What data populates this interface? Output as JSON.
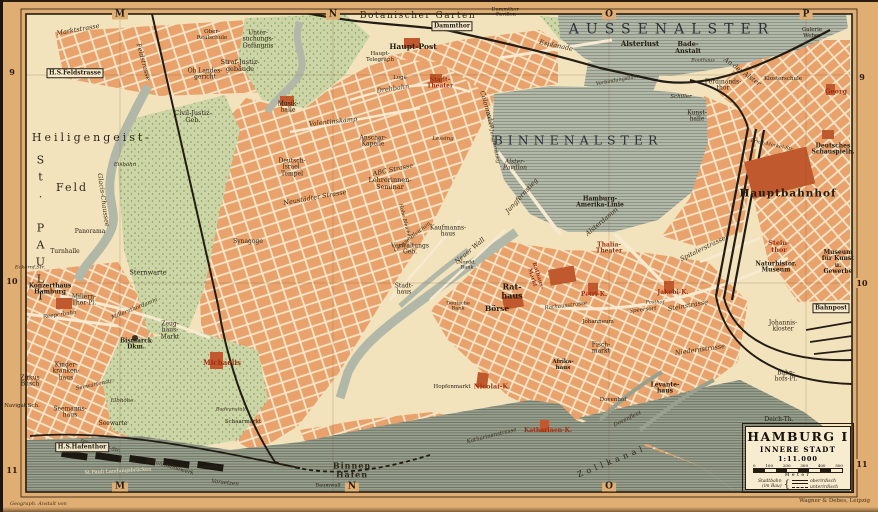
{
  "palette": {
    "paper": "#e0ad72",
    "mapbg": "#f3e3bd",
    "water": "#b2b8a8",
    "harbor": "#99a08e",
    "block": "#e9a26b",
    "park": "#ccd5a5",
    "red": "#c05a2e",
    "rail": "#221c14",
    "ink": "#241c10",
    "lred": "#9e2e12",
    "boxbg": "#f7ecd0"
  },
  "sheet": {
    "attribution_left": "Geograph. Anstalt von",
    "attribution_right": "Wagner & Debes, Leipzig"
  },
  "map": {
    "title_box": {
      "title": "HAMBURG I",
      "subtitle": "INNERE STADT",
      "scale": "1:11.000",
      "scale_ticks": [
        "0",
        "100",
        "200",
        "300",
        "400",
        "500"
      ],
      "scale_unit": "Meter",
      "legend_label": "Stadtbahn\n(im Bau)",
      "legend_brace": "{",
      "legend_items": [
        "oberirdisch",
        "unterirdisch"
      ]
    },
    "grid": {
      "top": [
        {
          "t": "M",
          "x": 120
        },
        {
          "t": "N",
          "x": 333
        },
        {
          "t": "O",
          "x": 609
        },
        {
          "t": "P",
          "x": 806
        }
      ],
      "bottom": [
        {
          "t": "M",
          "x": 120
        },
        {
          "t": "N",
          "x": 352
        },
        {
          "t": "O",
          "x": 609
        }
      ],
      "left": [
        {
          "t": "9",
          "y": 72
        },
        {
          "t": "10",
          "y": 281
        },
        {
          "t": "11",
          "y": 470
        }
      ],
      "right": [
        {
          "t": "9",
          "y": 77
        },
        {
          "t": "10",
          "y": 283
        },
        {
          "t": "11",
          "y": 464
        }
      ]
    },
    "labels": [
      {
        "t": "AUSSENALSTER",
        "x": 672,
        "y": 30,
        "c": "xl",
        "fs": 14,
        "ls": 7
      },
      {
        "t": "BINNENALSTER",
        "x": 578,
        "y": 140,
        "c": "xl",
        "fs": 12.5,
        "ls": 5
      },
      {
        "t": "Heiligengeist-",
        "x": 92,
        "y": 138,
        "c": "dist",
        "fs": 11,
        "ls": 3
      },
      {
        "t": "Feld",
        "x": 72,
        "y": 188,
        "c": "dist",
        "fs": 11,
        "ls": 2
      },
      {
        "t": "St. PAULI",
        "x": 40,
        "y": 230,
        "c": "dist vert",
        "fs": 11,
        "ls": 4
      },
      {
        "t": "Botanischer Garten",
        "x": 418,
        "y": 17,
        "c": "dist",
        "fs": 9,
        "ls": 1.5
      },
      {
        "t": "Binnen\nHafen",
        "x": 352,
        "y": 470,
        "c": "dist bb",
        "fs": 8,
        "ls": 1
      },
      {
        "t": "Zollkanal",
        "x": 612,
        "y": 462,
        "c": "dist",
        "fs": 8,
        "ls": 4,
        "rot": -22
      },
      {
        "t": "Marktstrasse",
        "x": 78,
        "y": 30,
        "c": "st",
        "rot": -10
      },
      {
        "t": "Feldstrasse",
        "x": 143,
        "y": 62,
        "c": "st",
        "rot": 75
      },
      {
        "t": "Glacis-Chaussee",
        "x": 103,
        "y": 200,
        "c": "st",
        "rot": 82
      },
      {
        "t": "Millernthordamm",
        "x": 135,
        "y": 310,
        "c": "st",
        "rot": -22,
        "fs": 5.5
      },
      {
        "t": "Reeperbahn",
        "x": 60,
        "y": 316,
        "c": "st",
        "rot": -8,
        "fs": 5.5
      },
      {
        "t": "Eckernf.Str.",
        "x": 30,
        "y": 268,
        "c": "st",
        "fs": 5
      },
      {
        "t": "Seewartenstr.",
        "x": 95,
        "y": 386,
        "c": "st",
        "rot": -12,
        "fs": 5.5
      },
      {
        "t": "Ditmar-Koel-Str.",
        "x": 100,
        "y": 447,
        "c": "st",
        "rot": 14,
        "fs": 5
      },
      {
        "t": "Valentinskamp",
        "x": 333,
        "y": 122,
        "c": "st",
        "rot": -6
      },
      {
        "t": "Drehbahn",
        "x": 393,
        "y": 89,
        "c": "st",
        "rot": -8
      },
      {
        "t": "Neustädter Strasse",
        "x": 315,
        "y": 198,
        "c": "st",
        "rot": -10
      },
      {
        "t": "ABC Strasse",
        "x": 393,
        "y": 170,
        "c": "st",
        "rot": -12
      },
      {
        "t": "Colonnaden",
        "x": 487,
        "y": 110,
        "c": "st",
        "rot": 74
      },
      {
        "t": "Esplanade",
        "x": 556,
        "y": 46,
        "c": "st",
        "rot": 12
      },
      {
        "t": "Neuer Jungfernstieg",
        "x": 492,
        "y": 138,
        "c": "st",
        "rot": 78,
        "fs": 5
      },
      {
        "t": "Jungfernstieg",
        "x": 522,
        "y": 196,
        "c": "st",
        "rot": -48
      },
      {
        "t": "Alsterdamm",
        "x": 602,
        "y": 222,
        "c": "st",
        "rot": -40
      },
      {
        "t": "An der Alster",
        "x": 742,
        "y": 72,
        "c": "st",
        "rot": 36
      },
      {
        "t": "Verbindungsbahn",
        "x": 618,
        "y": 81,
        "c": "st",
        "rot": -10,
        "fs": 5
      },
      {
        "t": "Grosse Bleichen",
        "x": 413,
        "y": 238,
        "c": "st",
        "rot": -38,
        "fs": 5.5
      },
      {
        "t": "Hohe Bleichen",
        "x": 404,
        "y": 222,
        "c": "st",
        "rot": 76,
        "fs": 5
      },
      {
        "t": "Neuer Wall",
        "x": 470,
        "y": 251,
        "c": "st",
        "rot": -40
      },
      {
        "t": "Rathausstrasse",
        "x": 566,
        "y": 307,
        "c": "st",
        "rot": -7,
        "fs": 5.5
      },
      {
        "t": "Speersort",
        "x": 643,
        "y": 311,
        "c": "st",
        "rot": -6,
        "fs": 5.5
      },
      {
        "t": "Steinstrasse",
        "x": 688,
        "y": 306,
        "c": "st",
        "rot": -10
      },
      {
        "t": "Spitalerstrasse",
        "x": 703,
        "y": 249,
        "c": "st",
        "rot": -26
      },
      {
        "t": "Niedernstrasse",
        "x": 700,
        "y": 350,
        "c": "st",
        "rot": -8
      },
      {
        "t": "Katharinenstrasse",
        "x": 492,
        "y": 437,
        "c": "st",
        "rot": -14,
        "fs": 5.5
      },
      {
        "t": "Dovenfleet",
        "x": 628,
        "y": 420,
        "c": "st",
        "rot": -26,
        "fs": 5.5
      },
      {
        "t": "Ernst-Merkel-Str.",
        "x": 772,
        "y": 146,
        "c": "st",
        "rot": 12,
        "fs": 5
      },
      {
        "t": "Johannisbollwerk",
        "x": 170,
        "y": 468,
        "c": "st",
        "rot": 16,
        "fs": 5.5
      },
      {
        "t": "Vorsetzen",
        "x": 225,
        "y": 484,
        "c": "st",
        "rot": 6,
        "fs": 5.5
      },
      {
        "t": "Ober-\nRealschule",
        "x": 212,
        "y": 36,
        "fs": 5.5
      },
      {
        "t": "Unter-\nsuchungs-\nGefängnis",
        "x": 258,
        "y": 40,
        "fs": 6
      },
      {
        "t": "Straf-Justiz-\ngebäude",
        "x": 240,
        "y": 66,
        "fs": 6.5
      },
      {
        "t": "Ob.Landes-\ngericht",
        "x": 205,
        "y": 75,
        "fs": 6
      },
      {
        "t": "H.S.Feldstrasse",
        "x": 75,
        "y": 73,
        "c": "stn"
      },
      {
        "t": "Civil-Justiz-\nGeb.",
        "x": 193,
        "y": 117,
        "fs": 6.5
      },
      {
        "t": "Dammthor",
        "x": 452,
        "y": 26,
        "c": "stn"
      },
      {
        "t": "Dammthor-\nPavillon",
        "x": 506,
        "y": 13,
        "fs": 5
      },
      {
        "t": "Haupt-Post",
        "x": 413,
        "y": 47,
        "c": "bb",
        "fs": 7.5
      },
      {
        "t": "Haupt-\nTelegraph",
        "x": 380,
        "y": 58,
        "fs": 5.5
      },
      {
        "t": "Stadt-\nTheater",
        "x": 440,
        "y": 84,
        "c": "r",
        "fs": 6
      },
      {
        "t": "Loge",
        "x": 400,
        "y": 79,
        "fs": 5.5
      },
      {
        "t": "Musik-\nhalle",
        "x": 288,
        "y": 108,
        "fs": 6
      },
      {
        "t": "Anschar-\nKapelle",
        "x": 373,
        "y": 142,
        "fs": 6
      },
      {
        "t": "Lessing",
        "x": 443,
        "y": 140,
        "c": "st",
        "fs": 5.5
      },
      {
        "t": "Lehrerinnen-\nSeminar",
        "x": 390,
        "y": 184,
        "fs": 6.5
      },
      {
        "t": "Deutsch-\nIsrael.\nTempel",
        "x": 292,
        "y": 168,
        "fs": 6
      },
      {
        "t": "Synagoge",
        "x": 248,
        "y": 242,
        "fs": 6
      },
      {
        "t": "Eisbahn",
        "x": 125,
        "y": 166,
        "c": "st",
        "fs": 5.5
      },
      {
        "t": "Panorama",
        "x": 90,
        "y": 232,
        "fs": 6
      },
      {
        "t": "Turnhalle",
        "x": 65,
        "y": 252,
        "fs": 6
      },
      {
        "t": "Sternwarte",
        "x": 148,
        "y": 273,
        "fs": 6.5
      },
      {
        "t": "Konzerthaus\nHamburg",
        "x": 50,
        "y": 290,
        "c": "bb",
        "fs": 6
      },
      {
        "t": "Millern-\nThor-Pl.",
        "x": 84,
        "y": 301,
        "fs": 6
      },
      {
        "t": "Zirkus\nBusch",
        "x": 30,
        "y": 382,
        "fs": 6
      },
      {
        "t": "Bismarck\nDkm.",
        "x": 136,
        "y": 345,
        "c": "bb",
        "fs": 6
      },
      {
        "t": "Zeug-\nhaus-\nMarkt",
        "x": 170,
        "y": 331,
        "fs": 6
      },
      {
        "t": "Kinder-\nkranken-\nhaus",
        "x": 66,
        "y": 372,
        "fs": 6
      },
      {
        "t": "Seemanns-\nhaus",
        "x": 70,
        "y": 413,
        "fs": 6
      },
      {
        "t": "Navigat.Sch.",
        "x": 22,
        "y": 407,
        "fs": 5.5
      },
      {
        "t": "Seewarte",
        "x": 113,
        "y": 424,
        "fs": 6
      },
      {
        "t": "Elbhöhe",
        "x": 122,
        "y": 402,
        "c": "st",
        "fs": 5.5
      },
      {
        "t": "H.S.Hafenthor",
        "x": 82,
        "y": 447,
        "c": "stn"
      },
      {
        "t": "Michaelis",
        "x": 222,
        "y": 363,
        "c": "r",
        "fs": 7
      },
      {
        "t": "Badeanstalt",
        "x": 231,
        "y": 410,
        "c": "st",
        "fs": 5
      },
      {
        "t": "Schaarmarkt",
        "x": 243,
        "y": 423,
        "fs": 5.5
      },
      {
        "t": "St.Pauli Landungsbrücken",
        "x": 118,
        "y": 472,
        "c": "lt",
        "fs": 5,
        "rot": -3
      },
      {
        "t": "Baumwall",
        "x": 328,
        "y": 486,
        "fs": 5
      },
      {
        "t": "Hopfenmarkt",
        "x": 452,
        "y": 388,
        "fs": 5.5
      },
      {
        "t": "Nicolai-K.",
        "x": 492,
        "y": 387,
        "c": "r",
        "fs": 6.5
      },
      {
        "t": "Katharinen-K.",
        "x": 548,
        "y": 431,
        "c": "r",
        "fs": 6
      },
      {
        "t": "Rat-\nhaus",
        "x": 512,
        "y": 291,
        "c": "bb",
        "fs": 8
      },
      {
        "t": "Börse",
        "x": 497,
        "y": 309,
        "c": "bb",
        "fs": 7.5
      },
      {
        "t": "Rathaus-\nMarkt",
        "x": 534,
        "y": 277,
        "c": "r",
        "fs": 5.5,
        "rot": 72
      },
      {
        "t": "Verwaltungs\nGeb.",
        "x": 410,
        "y": 250,
        "fs": 6
      },
      {
        "t": "Stadt-\nhaus",
        "x": 404,
        "y": 290,
        "fs": 6
      },
      {
        "t": "Nordd.\nBank",
        "x": 467,
        "y": 266,
        "fs": 5
      },
      {
        "t": "Deutsche\nBank",
        "x": 458,
        "y": 307,
        "fs": 5
      },
      {
        "t": "Kaufmanns-\nhaus",
        "x": 448,
        "y": 232,
        "fs": 6
      },
      {
        "t": "Alster-\nPavillon",
        "x": 515,
        "y": 166,
        "c": "st",
        "fs": 6
      },
      {
        "t": "Hamburg-\nAmerika-Linie",
        "x": 600,
        "y": 203,
        "c": "bb",
        "fs": 6
      },
      {
        "t": "Thalia-\nTheater",
        "x": 609,
        "y": 249,
        "c": "r",
        "fs": 6
      },
      {
        "t": "Petri-K.",
        "x": 594,
        "y": 295,
        "c": "r",
        "fs": 6
      },
      {
        "t": "Jakobi-K.",
        "x": 673,
        "y": 293,
        "c": "r",
        "fs": 6
      },
      {
        "t": "Posthof",
        "x": 655,
        "y": 303,
        "c": "st",
        "fs": 5
      },
      {
        "t": "Johanneum",
        "x": 598,
        "y": 323,
        "fs": 5.5
      },
      {
        "t": "Fisch-\nmarkt",
        "x": 601,
        "y": 349,
        "fs": 6
      },
      {
        "t": "Afrika-\nhaus",
        "x": 563,
        "y": 366,
        "c": "bb",
        "fs": 5.5
      },
      {
        "t": "Dovenhof",
        "x": 613,
        "y": 401,
        "fs": 5.5
      },
      {
        "t": "Levante-\nhaus",
        "x": 665,
        "y": 389,
        "c": "bb",
        "fs": 6
      },
      {
        "t": "Johannis-\nkloster",
        "x": 783,
        "y": 327,
        "fs": 6
      },
      {
        "t": "Bahnpost",
        "x": 831,
        "y": 308,
        "c": "stn"
      },
      {
        "t": "Bahn-\nhofs-Pl.",
        "x": 786,
        "y": 377,
        "fs": 6
      },
      {
        "t": "Deich-Th.",
        "x": 779,
        "y": 420,
        "fs": 6
      },
      {
        "t": "Hauptbahnhof",
        "x": 788,
        "y": 194,
        "c": "bb",
        "fs": 10.5,
        "ls": 1
      },
      {
        "t": "Stein-\nthor",
        "x": 779,
        "y": 247,
        "c": "r",
        "fs": 6.5
      },
      {
        "t": "Naturhistor.\nMuseum",
        "x": 776,
        "y": 268,
        "c": "bb",
        "fs": 6
      },
      {
        "t": "Museum\nfür Kunst u.\nGewerbe",
        "x": 838,
        "y": 263,
        "c": "bb",
        "fs": 6
      },
      {
        "t": "Deutsches\nSchauspielh.",
        "x": 833,
        "y": 150,
        "c": "bb",
        "fs": 6
      },
      {
        "t": "Georg",
        "x": 836,
        "y": 92,
        "c": "r",
        "fs": 6.5
      },
      {
        "t": "Klosterschule",
        "x": 783,
        "y": 80,
        "fs": 5.5
      },
      {
        "t": "Galerie\nWeber",
        "x": 812,
        "y": 34,
        "fs": 5.5
      },
      {
        "t": "Kunst-\nhalle",
        "x": 697,
        "y": 117,
        "fs": 6
      },
      {
        "t": "Alsterlust",
        "x": 640,
        "y": 44,
        "c": "bb",
        "fs": 7
      },
      {
        "t": "Bade-\nAnstalt",
        "x": 688,
        "y": 48,
        "c": "bb",
        "fs": 6.5
      },
      {
        "t": "Boothaus",
        "x": 703,
        "y": 61,
        "c": "st",
        "fs": 5
      },
      {
        "t": "Ferdinands-\nthor",
        "x": 723,
        "y": 86,
        "fs": 6
      },
      {
        "t": "Schiller",
        "x": 681,
        "y": 98,
        "c": "st",
        "fs": 5.5
      }
    ]
  }
}
